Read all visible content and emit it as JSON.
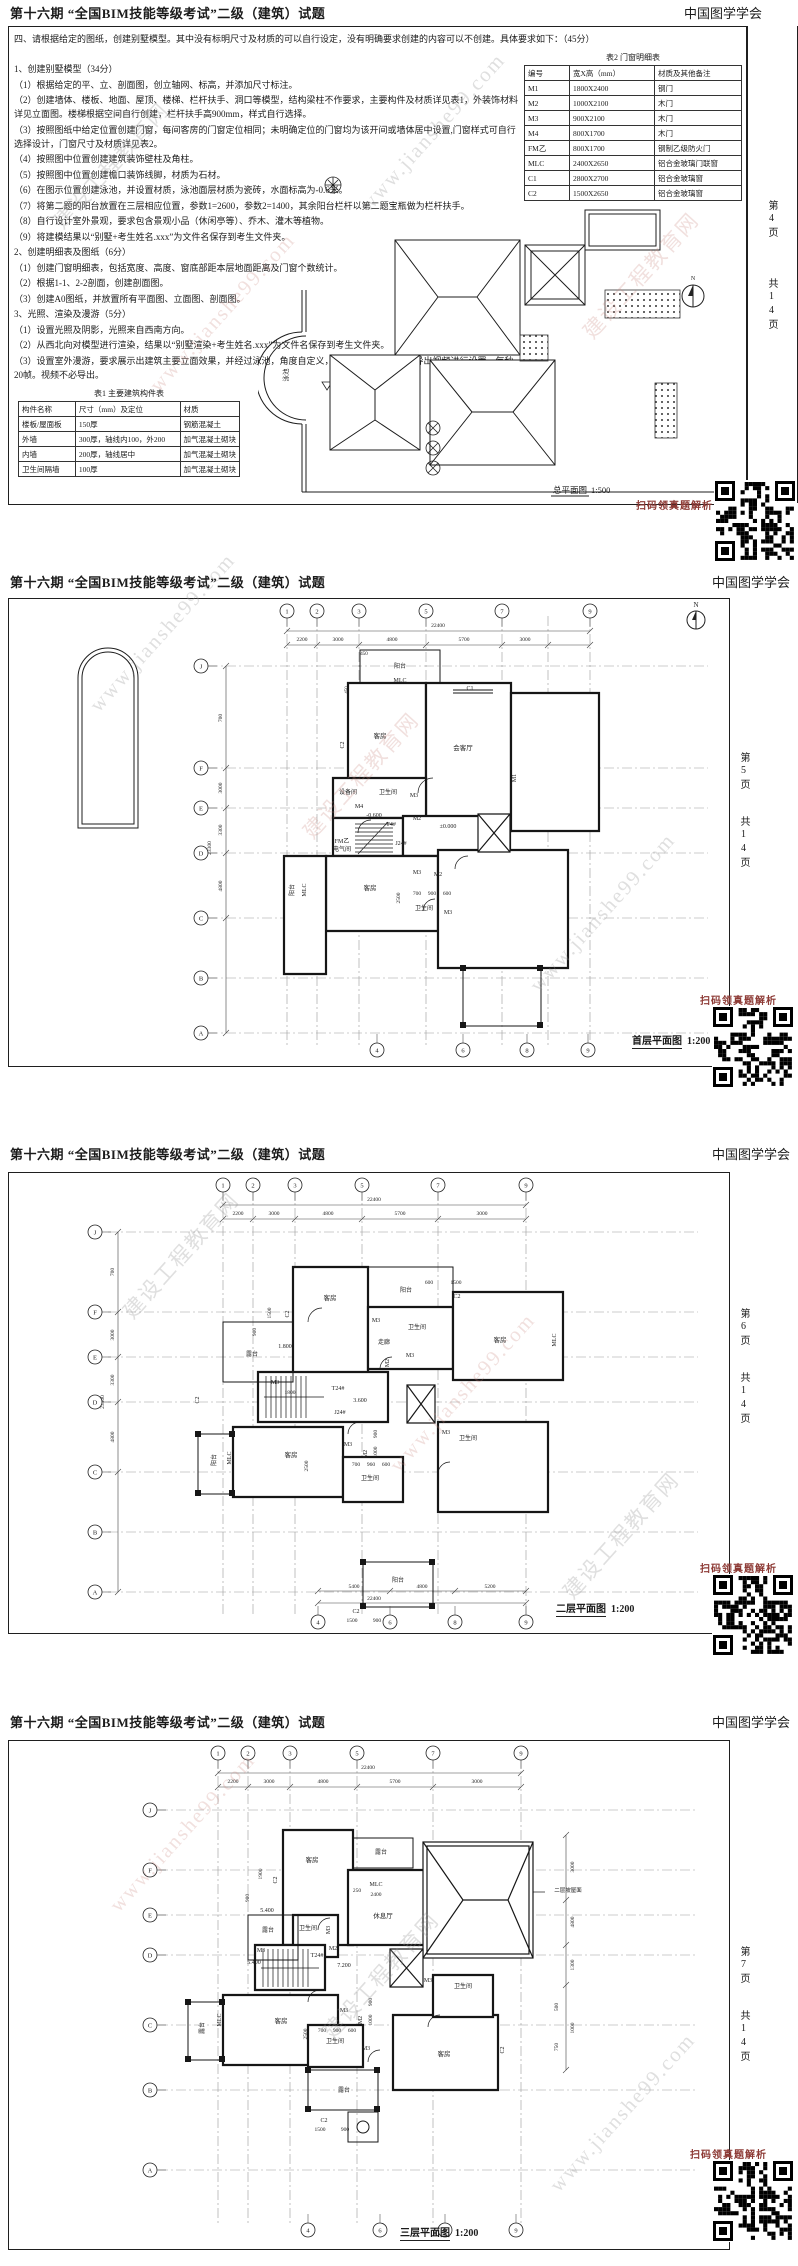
{
  "document": {
    "title": "第十六期 “全国BIM技能等级考试”二级（建筑）试题",
    "org": "中国图学学会",
    "pages_total": "共14页"
  },
  "watermark": {
    "name": "建设工程教育网",
    "url": "www.jianshe99.com"
  },
  "qr_caption": "扫码领真题解析",
  "page1": {
    "page_no": "第4页",
    "intro": "四、请根据给定的图纸，创建别墅模型。其中没有标明尺寸及材质的可以自行设定，没有明确要求创建的内容可以不创建。具体要求如下：（45分）",
    "items": [
      "1、创建别墅模型（34分）",
      "（1）根据给定的平、立、剖面图，创立轴网、标高，并添加尺寸标注。",
      "（2）创建墙体、楼板、地面、屋顶、楼梯、栏杆扶手、洞口等模型，结构梁柱不作要求，主要构件及材质详见表1，外装饰材料详见立面图。楼梯根据空间自行创建，栏杆扶手高900mm，样式自行选择。",
      "（3）按照图纸中给定位置创建门窗，每间客房的门窗定位相同；未明确定位的门窗均为该开间或墙体居中设置,门窗样式可自行选择设计，门窗尺寸及材质详见表2。",
      "（4）按照图中位置创建建筑装饰壁柱及角柱。",
      "（5）按照图中位置创建檐口装饰线脚，材质为石材。",
      "（6）在图示位置创建泳池，并设置材质，泳池面层材质为瓷砖，水面标高为-0.6米。",
      "（7）将第二题的阳台放置在三层相应位置，参数1=2600，参数2=1400，其余阳台栏杆以第二题宝瓶做为栏杆扶手。",
      "（8）自行设计室外景观，要求包含景观小品（休闲亭等）、乔木、灌木等植物。",
      "（9）将建模结果以“别墅+考生姓名.xxx”为文件名保存到考生文件夹。",
      "2、创建明细表及图纸（6分）",
      "（1）创建门窗明细表，包括宽度、高度、窗底部距本层地面距离及门窗个数统计。",
      "（2）根据1-1、2-2剖面，创建剖面图。",
      "（3）创建A0图纸，并放置所有平面图、立面图、剖面图。",
      "3、光照、渲染及漫游（5分）",
      "（1）设置光照及阴影，光照来自西南方向。",
      "（2）从西北向对模型进行渲染，结果以“别墅渲染+考生姓名.xxx”为文件名保存到考生文件夹。",
      "（3）设置室外漫游，要求展示出建筑主要立面效果，并经过泳池，角度自定义，时间不超过15秒。对导出视频进行设置，每秒20帧。视频不必导出。"
    ],
    "table2": {
      "caption": "表2 门窗明细表",
      "headers": [
        "编号",
        "宽X高（mm）",
        "材质及其他备注"
      ],
      "rows": [
        [
          "M1",
          "1800X2400",
          "钢门"
        ],
        [
          "M2",
          "1000X2100",
          "木门"
        ],
        [
          "M3",
          "900X2100",
          "木门"
        ],
        [
          "M4",
          "800X1700",
          "木门"
        ],
        [
          "FM乙",
          "800X1700",
          "钢制乙级防火门"
        ],
        [
          "MLC",
          "2400X2650",
          "铝合金玻璃门联窗"
        ],
        [
          "C1",
          "2800X2700",
          "铝合金玻璃窗"
        ],
        [
          "C2",
          "1500X2650",
          "铝合金玻璃窗"
        ]
      ]
    },
    "table1": {
      "caption": "表1 主要建筑构件表",
      "headers": [
        "构件名称",
        "尺寸（mm）及定位",
        "材质"
      ],
      "rows": [
        [
          "楼板/屋面板",
          "150厚",
          "钢筋混凝土"
        ],
        [
          "外墙",
          "300厚，轴线内100，外200",
          "加气混凝土砌块"
        ],
        [
          "内墙",
          "200厚，轴线居中",
          "加气混凝土砌块"
        ],
        [
          "卫生间隔墙",
          "100厚",
          "加气混凝土砌块"
        ]
      ]
    },
    "site": {
      "title": "总平面图",
      "scale": "1:500",
      "pool": "泳池",
      "pool_level": "-0.60",
      "north": "N"
    }
  },
  "plan1": {
    "page_no": "第5页",
    "title": "首层平面图",
    "scale": "1:200",
    "bub_top": [
      {
        "t": "1",
        "x": 279
      },
      {
        "t": "2",
        "x": 309
      },
      {
        "t": "3",
        "x": 351
      },
      {
        "t": "5",
        "x": 418
      },
      {
        "t": "7",
        "x": 494
      },
      {
        "t": "9",
        "x": 582
      }
    ],
    "bub_bottom": [
      {
        "t": "4",
        "x": 369
      },
      {
        "t": "6",
        "x": 455
      },
      {
        "t": "8",
        "x": 519
      },
      {
        "t": "9",
        "x": 580
      }
    ],
    "bub_left": [
      {
        "t": "J",
        "y": 68
      },
      {
        "t": "F",
        "y": 170
      },
      {
        "t": "E",
        "y": 210
      },
      {
        "t": "D",
        "y": 255
      },
      {
        "t": "C",
        "y": 320
      },
      {
        "t": "B",
        "y": 380
      },
      {
        "t": "A",
        "y": 435
      }
    ],
    "ann": [
      {
        "t": "22400",
        "x": 430,
        "y": 29,
        "s": 5.5
      },
      {
        "t": "2200",
        "x": 294,
        "y": 43,
        "s": 5.5
      },
      {
        "t": "3000",
        "x": 330,
        "y": 43,
        "s": 5.5
      },
      {
        "t": "4800",
        "x": 384,
        "y": 43,
        "s": 5.5
      },
      {
        "t": "5700",
        "x": 456,
        "y": 43,
        "s": 5.5
      },
      {
        "t": "3000",
        "x": 517,
        "y": 43,
        "s": 5.5
      },
      {
        "t": "700",
        "x": 214,
        "y": 120,
        "s": 5.5,
        "v": 1
      },
      {
        "t": "3000",
        "x": 214,
        "y": 190,
        "s": 5.5,
        "v": 1
      },
      {
        "t": "3300",
        "x": 214,
        "y": 232,
        "s": 5.5,
        "v": 1
      },
      {
        "t": "4800",
        "x": 214,
        "y": 288,
        "s": 5.5,
        "v": 1
      },
      {
        "t": "23300",
        "x": 203,
        "y": 250,
        "s": 5.5,
        "v": 1
      },
      {
        "t": "450",
        "x": 356,
        "y": 57,
        "s": 5
      },
      {
        "t": "450",
        "x": 340,
        "y": 92,
        "s": 5,
        "v": 1
      },
      {
        "t": "N",
        "x": 688,
        "y": 9,
        "s": 7
      },
      {
        "t": "阳台",
        "x": 392,
        "y": 70,
        "s": 6
      },
      {
        "t": "MLC",
        "x": 392,
        "y": 84,
        "s": 6
      },
      {
        "t": "C1",
        "x": 462,
        "y": 92,
        "s": 6
      },
      {
        "t": "客房",
        "x": 372,
        "y": 140,
        "s": 6.5
      },
      {
        "t": "会客厅",
        "x": 455,
        "y": 152,
        "s": 6.5
      },
      {
        "t": "C2",
        "x": 336,
        "y": 147,
        "s": 6,
        "v": 1
      },
      {
        "t": "M1",
        "x": 508,
        "y": 180,
        "s": 6,
        "v": 1
      },
      {
        "t": "设备间",
        "x": 340,
        "y": 196,
        "s": 6
      },
      {
        "t": "卫生间",
        "x": 380,
        "y": 196,
        "s": 6
      },
      {
        "t": "M3",
        "x": 406,
        "y": 199,
        "s": 6
      },
      {
        "t": "M4",
        "x": 351,
        "y": 210,
        "s": 6
      },
      {
        "t": "-0.600",
        "x": 366,
        "y": 219,
        "s": 6
      },
      {
        "t": "T4#",
        "x": 383,
        "y": 228,
        "s": 6
      },
      {
        "t": "M2",
        "x": 409,
        "y": 222,
        "s": 6
      },
      {
        "t": "±0.000",
        "x": 440,
        "y": 230,
        "s": 6
      },
      {
        "t": "FM乙",
        "x": 334,
        "y": 245,
        "s": 6
      },
      {
        "t": "电气间",
        "x": 334,
        "y": 253,
        "s": 6
      },
      {
        "t": "J24#",
        "x": 393,
        "y": 247,
        "s": 6
      },
      {
        "t": "客房",
        "x": 362,
        "y": 292,
        "s": 6.5
      },
      {
        "t": "MLC",
        "x": 298,
        "y": 292,
        "s": 6,
        "v": 1
      },
      {
        "t": "阳台",
        "x": 286,
        "y": 292,
        "s": 6,
        "v": 1
      },
      {
        "t": "M3",
        "x": 409,
        "y": 276,
        "s": 6
      },
      {
        "t": "M2",
        "x": 430,
        "y": 278,
        "s": 6
      },
      {
        "t": "2500",
        "x": 392,
        "y": 300,
        "s": 5.5,
        "v": 1
      },
      {
        "t": "700",
        "x": 409,
        "y": 297,
        "s": 5.5
      },
      {
        "t": "900",
        "x": 424,
        "y": 297,
        "s": 5.5
      },
      {
        "t": "600",
        "x": 439,
        "y": 297,
        "s": 5.5
      },
      {
        "t": "卫生间",
        "x": 416,
        "y": 312,
        "s": 6
      },
      {
        "t": "M3",
        "x": 440,
        "y": 316,
        "s": 6
      }
    ]
  },
  "plan2": {
    "page_no": "第6页",
    "title": "二层平面图",
    "scale": "1:200",
    "bub_top": [
      {
        "t": "1",
        "x": 215
      },
      {
        "t": "2",
        "x": 245
      },
      {
        "t": "3",
        "x": 287
      },
      {
        "t": "5",
        "x": 354
      },
      {
        "t": "7",
        "x": 430
      },
      {
        "t": "9",
        "x": 518
      }
    ],
    "bub_bottom": [
      {
        "t": "4",
        "x": 310
      },
      {
        "t": "6",
        "x": 382
      },
      {
        "t": "8",
        "x": 447
      },
      {
        "t": "9",
        "x": 518
      }
    ],
    "bub_left": [
      {
        "t": "J",
        "y": 60
      },
      {
        "t": "F",
        "y": 140
      },
      {
        "t": "E",
        "y": 185
      },
      {
        "t": "D",
        "y": 230
      },
      {
        "t": "C",
        "y": 300
      },
      {
        "t": "B",
        "y": 360
      },
      {
        "t": "A",
        "y": 420
      }
    ],
    "ann": [
      {
        "t": "22400",
        "x": 366,
        "y": 29,
        "s": 5.5
      },
      {
        "t": "2200",
        "x": 230,
        "y": 43,
        "s": 5.5
      },
      {
        "t": "3000",
        "x": 266,
        "y": 43,
        "s": 5.5
      },
      {
        "t": "4800",
        "x": 320,
        "y": 43,
        "s": 5.5
      },
      {
        "t": "5700",
        "x": 392,
        "y": 43,
        "s": 5.5
      },
      {
        "t": "3000",
        "x": 474,
        "y": 43,
        "s": 5.5
      },
      {
        "t": "5400",
        "x": 346,
        "y": 416,
        "s": 5.5
      },
      {
        "t": "4800",
        "x": 414,
        "y": 416,
        "s": 5.5
      },
      {
        "t": "5200",
        "x": 482,
        "y": 416,
        "s": 5.5
      },
      {
        "t": "22400",
        "x": 366,
        "y": 428,
        "s": 5.5
      },
      {
        "t": "700",
        "x": 106,
        "y": 100,
        "s": 5.5,
        "v": 1
      },
      {
        "t": "3000",
        "x": 106,
        "y": 163,
        "s": 5.5,
        "v": 1
      },
      {
        "t": "3300",
        "x": 106,
        "y": 208,
        "s": 5.5,
        "v": 1
      },
      {
        "t": "4800",
        "x": 106,
        "y": 265,
        "s": 5.5,
        "v": 1
      },
      {
        "t": "23300",
        "x": 96,
        "y": 230,
        "s": 5.5,
        "v": 1
      },
      {
        "t": "客房",
        "x": 322,
        "y": 128,
        "s": 6.5
      },
      {
        "t": "C2",
        "x": 281,
        "y": 142,
        "s": 6,
        "v": 1
      },
      {
        "t": "1500",
        "x": 263,
        "y": 141,
        "s": 5.5,
        "v": 1
      },
      {
        "t": "900",
        "x": 248,
        "y": 160,
        "s": 5.5,
        "v": 1
      },
      {
        "t": "1.800",
        "x": 277,
        "y": 176,
        "s": 6
      },
      {
        "t": "露台",
        "x": 244,
        "y": 184,
        "s": 6
      },
      {
        "t": "阳台",
        "x": 398,
        "y": 120,
        "s": 6
      },
      {
        "t": "600",
        "x": 421,
        "y": 112,
        "s": 5.5
      },
      {
        "t": "1500",
        "x": 448,
        "y": 112,
        "s": 5.5
      },
      {
        "t": "C2",
        "x": 449,
        "y": 126,
        "s": 6
      },
      {
        "t": "M3",
        "x": 368,
        "y": 150,
        "s": 6
      },
      {
        "t": "卫生间",
        "x": 409,
        "y": 157,
        "s": 6
      },
      {
        "t": "走廊",
        "x": 376,
        "y": 172,
        "s": 6
      },
      {
        "t": "M3",
        "x": 402,
        "y": 185,
        "s": 6
      },
      {
        "t": "M2",
        "x": 381,
        "y": 191,
        "s": 6,
        "v": 1
      },
      {
        "t": "客房",
        "x": 492,
        "y": 170,
        "s": 6.5
      },
      {
        "t": "MLC",
        "x": 548,
        "y": 168,
        "s": 6,
        "v": 1
      },
      {
        "t": "M3",
        "x": 267,
        "y": 212,
        "s": 6
      },
      {
        "t": "1800",
        "x": 282,
        "y": 222,
        "s": 5.5
      },
      {
        "t": "T24#",
        "x": 330,
        "y": 218,
        "s": 6
      },
      {
        "t": "3.600",
        "x": 352,
        "y": 230,
        "s": 6
      },
      {
        "t": "J24#",
        "x": 332,
        "y": 242,
        "s": 6
      },
      {
        "t": "C2",
        "x": 191,
        "y": 228,
        "s": 6,
        "v": 1
      },
      {
        "t": "客房",
        "x": 283,
        "y": 285,
        "s": 6.5
      },
      {
        "t": "MLC",
        "x": 223,
        "y": 286,
        "s": 6,
        "v": 1
      },
      {
        "t": "阳台",
        "x": 208,
        "y": 288,
        "s": 6,
        "v": 1
      },
      {
        "t": "M3",
        "x": 340,
        "y": 274,
        "s": 6
      },
      {
        "t": "M2",
        "x": 359,
        "y": 282,
        "s": 6,
        "v": 1
      },
      {
        "t": "900",
        "x": 369,
        "y": 262,
        "s": 5.5,
        "v": 1
      },
      {
        "t": "1000",
        "x": 369,
        "y": 280,
        "s": 5.5,
        "v": 1
      },
      {
        "t": "卫生间",
        "x": 362,
        "y": 308,
        "s": 6
      },
      {
        "t": "2500",
        "x": 300,
        "y": 294,
        "s": 5.5,
        "v": 1
      },
      {
        "t": "700",
        "x": 348,
        "y": 294,
        "s": 5.5
      },
      {
        "t": "960",
        "x": 363,
        "y": 294,
        "s": 5.5
      },
      {
        "t": "600",
        "x": 378,
        "y": 294,
        "s": 5.5
      },
      {
        "t": "卫生间",
        "x": 460,
        "y": 268,
        "s": 6
      },
      {
        "t": "M3",
        "x": 438,
        "y": 262,
        "s": 6
      },
      {
        "t": "阳台",
        "x": 390,
        "y": 410,
        "s": 6
      },
      {
        "t": "C2",
        "x": 348,
        "y": 441,
        "s": 6
      },
      {
        "t": "1500",
        "x": 344,
        "y": 450,
        "s": 5.5
      },
      {
        "t": "900",
        "x": 369,
        "y": 450,
        "s": 5.5
      }
    ]
  },
  "plan3": {
    "page_no": "第7页",
    "title": "三层平面图",
    "scale": "1:200",
    "bub_top": [
      {
        "t": "1",
        "x": 210
      },
      {
        "t": "2",
        "x": 240
      },
      {
        "t": "3",
        "x": 282
      },
      {
        "t": "5",
        "x": 349
      },
      {
        "t": "7",
        "x": 425
      },
      {
        "t": "9",
        "x": 513
      }
    ],
    "bub_bottom": [
      {
        "t": "4",
        "x": 300
      },
      {
        "t": "6",
        "x": 372
      },
      {
        "t": "8",
        "x": 437
      },
      {
        "t": "9",
        "x": 508
      }
    ],
    "bub_left": [
      {
        "t": "J",
        "y": 70
      },
      {
        "t": "F",
        "y": 130
      },
      {
        "t": "E",
        "y": 175
      },
      {
        "t": "D",
        "y": 215
      },
      {
        "t": "C",
        "y": 285
      },
      {
        "t": "B",
        "y": 350
      },
      {
        "t": "A",
        "y": 430
      }
    ],
    "ann": [
      {
        "t": "22400",
        "x": 360,
        "y": 29,
        "s": 5.5
      },
      {
        "t": "2200",
        "x": 225,
        "y": 43,
        "s": 5.5
      },
      {
        "t": "3000",
        "x": 261,
        "y": 43,
        "s": 5.5
      },
      {
        "t": "4800",
        "x": 315,
        "y": 43,
        "s": 5.5
      },
      {
        "t": "5700",
        "x": 387,
        "y": 43,
        "s": 5.5
      },
      {
        "t": "3000",
        "x": 469,
        "y": 43,
        "s": 5.5
      },
      {
        "t": "3000",
        "x": 566,
        "y": 127,
        "s": 5.5,
        "v": 1
      },
      {
        "t": "4800",
        "x": 566,
        "y": 182,
        "s": 5.5,
        "v": 1
      },
      {
        "t": "1300",
        "x": 566,
        "y": 225,
        "s": 5.5,
        "v": 1
      },
      {
        "t": "1000",
        "x": 566,
        "y": 288,
        "s": 5.5,
        "v": 1
      },
      {
        "t": "客房",
        "x": 304,
        "y": 122,
        "s": 6.5
      },
      {
        "t": "露台",
        "x": 373,
        "y": 114,
        "s": 6
      },
      {
        "t": "1900",
        "x": 254,
        "y": 134,
        "s": 5.5,
        "v": 1
      },
      {
        "t": "C2",
        "x": 269,
        "y": 140,
        "s": 6,
        "v": 1
      },
      {
        "t": "900",
        "x": 241,
        "y": 158,
        "s": 5.5,
        "v": 1
      },
      {
        "t": "MLC",
        "x": 368,
        "y": 146,
        "s": 6
      },
      {
        "t": "2400",
        "x": 368,
        "y": 156,
        "s": 5.5
      },
      {
        "t": "250",
        "x": 349,
        "y": 152,
        "s": 5.5
      },
      {
        "t": "休息厅",
        "x": 375,
        "y": 178,
        "s": 6.5
      },
      {
        "t": "5.400",
        "x": 259,
        "y": 172,
        "s": 6
      },
      {
        "t": "露台",
        "x": 260,
        "y": 192,
        "s": 6
      },
      {
        "t": "卫生间",
        "x": 300,
        "y": 190,
        "s": 6
      },
      {
        "t": "M3",
        "x": 322,
        "y": 190,
        "s": 6,
        "v": 1
      },
      {
        "t": "M3",
        "x": 253,
        "y": 212,
        "s": 6
      },
      {
        "t": "5.400",
        "x": 246,
        "y": 224,
        "s": 6
      },
      {
        "t": "T24#",
        "x": 309,
        "y": 217,
        "s": 6
      },
      {
        "t": "M2",
        "x": 325,
        "y": 210,
        "s": 6
      },
      {
        "t": "7.200",
        "x": 336,
        "y": 227,
        "s": 6
      },
      {
        "t": "二层坡屋面",
        "x": 560,
        "y": 152,
        "s": 5.5
      },
      {
        "t": "客房",
        "x": 273,
        "y": 283,
        "s": 6.5
      },
      {
        "t": "MLC",
        "x": 213,
        "y": 280,
        "s": 6,
        "v": 1
      },
      {
        "t": "露台",
        "x": 196,
        "y": 288,
        "s": 6,
        "v": 1
      },
      {
        "t": "M3",
        "x": 336,
        "y": 272,
        "s": 6
      },
      {
        "t": "M2",
        "x": 354,
        "y": 280,
        "s": 6,
        "v": 1
      },
      {
        "t": "900",
        "x": 364,
        "y": 262,
        "s": 5.5,
        "v": 1
      },
      {
        "t": "1000",
        "x": 364,
        "y": 280,
        "s": 5.5,
        "v": 1
      },
      {
        "t": "2500",
        "x": 299,
        "y": 294,
        "s": 5.5,
        "v": 1
      },
      {
        "t": "700",
        "x": 314,
        "y": 292,
        "s": 5.5
      },
      {
        "t": "900",
        "x": 329,
        "y": 292,
        "s": 5.5
      },
      {
        "t": "600",
        "x": 344,
        "y": 292,
        "s": 5.5
      },
      {
        "t": "卫生间",
        "x": 327,
        "y": 303,
        "s": 6
      },
      {
        "t": "M3",
        "x": 358,
        "y": 310,
        "s": 6
      },
      {
        "t": "卫生间",
        "x": 455,
        "y": 248,
        "s": 6
      },
      {
        "t": "M3",
        "x": 420,
        "y": 242,
        "s": 6
      },
      {
        "t": "客房",
        "x": 436,
        "y": 316,
        "s": 6.5
      },
      {
        "t": "C2",
        "x": 496,
        "y": 310,
        "s": 6,
        "v": 1
      },
      {
        "t": "500",
        "x": 550,
        "y": 267,
        "s": 5.5,
        "v": 1
      },
      {
        "t": "750",
        "x": 550,
        "y": 307,
        "s": 5.5,
        "v": 1
      },
      {
        "t": "露台",
        "x": 336,
        "y": 352,
        "s": 6
      },
      {
        "t": "C2",
        "x": 316,
        "y": 382,
        "s": 6
      },
      {
        "t": "1500",
        "x": 312,
        "y": 391,
        "s": 5.5
      },
      {
        "t": "900",
        "x": 337,
        "y": 391,
        "s": 5.5
      }
    ]
  }
}
